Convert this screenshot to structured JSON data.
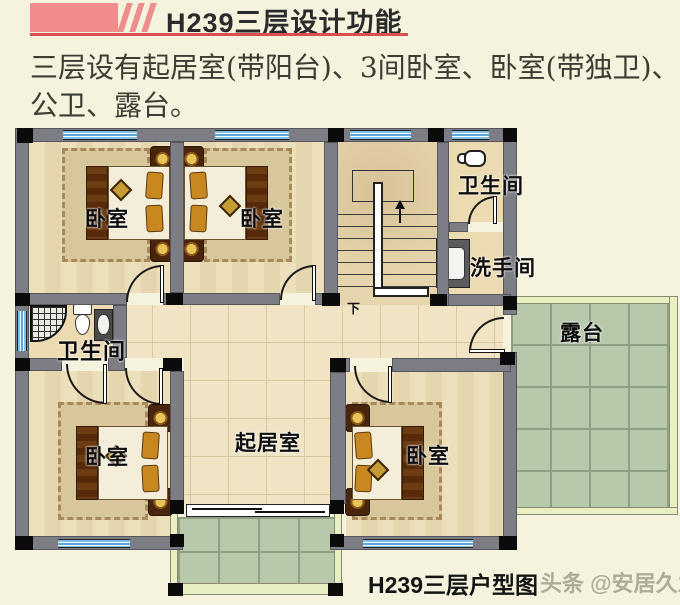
{
  "header": {
    "title": "H239三层设计功能"
  },
  "description": {
    "lines": [
      "三层设有起居室(带阳台)、3间卧室、卧室(带独卫)、",
      "公卫、露台。"
    ]
  },
  "plan": {
    "rooms": {
      "bedroom_top_left": "卧室",
      "bedroom_top_mid": "卧室",
      "bedroom_bottom_left": "卧室",
      "bedroom_bottom_right": "卧室",
      "bathroom_top": "卫生间",
      "bathroom_left": "卫生间",
      "washroom": "洗手间",
      "living_room": "起居室",
      "terrace": "露台",
      "stairs_down": "下"
    }
  },
  "footer": {
    "caption": "H239三层户型图",
    "watermark": "头条 @安居久业"
  },
  "colors": {
    "accent_pink": "#ef8d8d",
    "underline_red": "#d94f4f",
    "wall_gray": "#7d7d85",
    "window_blue": "#5aa6da",
    "terrace_green": "#b7c8ab",
    "terrace_border": "#e9efc0",
    "page_bg": "#f5f2dd"
  }
}
